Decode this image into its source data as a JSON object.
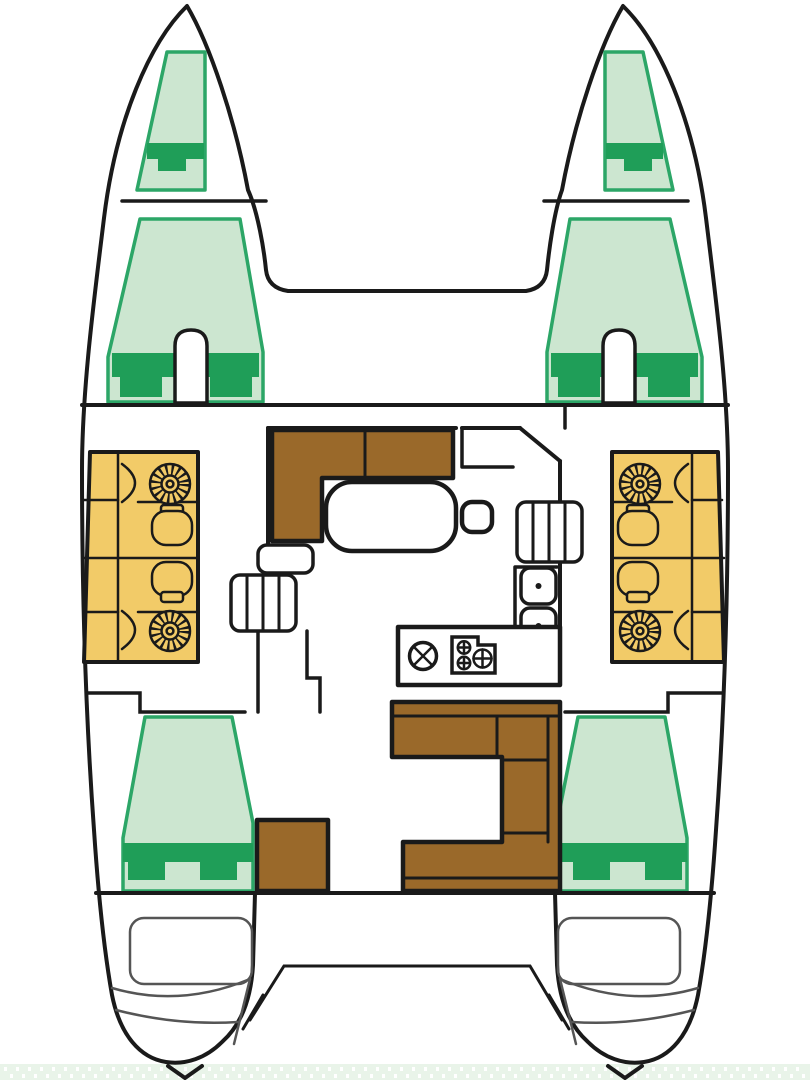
{
  "page": {
    "title": "catamaran-floor-plan",
    "background": "#ffffff",
    "width": 810,
    "height": 1080
  },
  "colors": {
    "outline": "#1a1a1a",
    "hull_fill": "#ffffff",
    "berth_fill": "#cce6d0",
    "berth_border": "#2ca667",
    "pillow_green": "#1f9e58",
    "wood_brown": "#9a692a",
    "cushion_yellow": "#f2cb68",
    "detail_gray": "#555555",
    "water_strip": "#e9f4e9",
    "white": "#ffffff"
  },
  "plan": {
    "vessel": "catamaran",
    "view": "top-down interior deck plan, bows up",
    "hulls": 2,
    "berth_count": 6,
    "areas": {
      "port_hull": [
        "forepeak-berth",
        "forward-cabin-berth",
        "bathroom-with-fan-and-toilet-x2",
        "companionway-steps",
        "aft-cabin-berth",
        "transom-steps",
        "rudder"
      ],
      "starboard_hull": [
        "forepeak-berth",
        "forward-cabin-berth",
        "bathroom-with-fan-and-toilet-x2",
        "companionway-steps",
        "aft-cabin-berth",
        "transom-steps",
        "rudder"
      ],
      "bridge_deck": [
        "trampoline-foredeck",
        "saloon-l-sofa",
        "saloon-table",
        "stool",
        "nav-desk",
        "double-sink-counter",
        "galley-counter-with-round-sink-and-stove",
        "cockpit-u-sofa",
        "cockpit-bench",
        "aft-platform"
      ]
    },
    "icon_inventory": {
      "fan-icon": 4,
      "toilet-icon": 4,
      "sink-square-icon": 2,
      "round-sink-icon": 1,
      "stove-burner-icon": 3,
      "pillow-blocks": 6,
      "rudder-icon": 2
    }
  }
}
